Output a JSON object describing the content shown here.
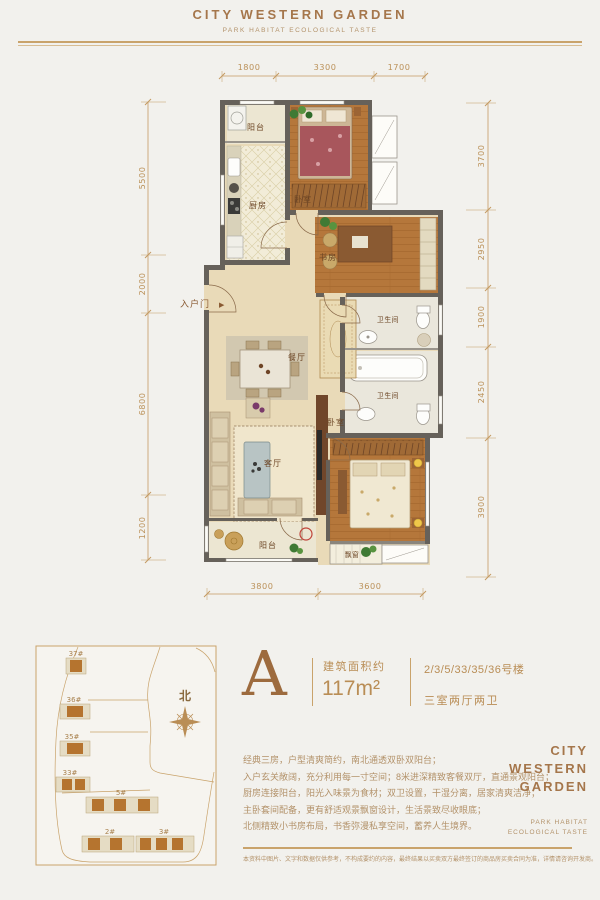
{
  "header": {
    "title": "CITY WESTERN GARDEN",
    "subtitle": "PARK HABITAT ECOLOGICAL TASTE"
  },
  "floor_plan": {
    "dims": {
      "top": [
        "1800",
        "3300",
        "1700"
      ],
      "bottom": [
        "3800",
        "3600"
      ],
      "left": [
        "5500",
        "2000",
        "6800",
        "1200"
      ],
      "right": [
        "3700",
        "2950",
        "1900",
        "2450",
        "3900"
      ]
    },
    "labels": {
      "balcony_top": "阳台",
      "kitchen": "厨房",
      "bedroom_north": "卧室",
      "study": "书房",
      "bath_upper": "卫生间",
      "bath_lower": "卫生间",
      "dining": "餐厅",
      "living": "客厅",
      "bedroom_master": "卧室",
      "balcony_bottom": "阳台",
      "bay_window": "飘窗",
      "entrance": "入户门",
      "entrance_arrow": "▶"
    }
  },
  "site_map": {
    "north": "北",
    "buildings": [
      "37#",
      "36#",
      "35#",
      "33#",
      "5#",
      "2#",
      "3#"
    ]
  },
  "unit": {
    "type_letter": "A",
    "area_label": "建筑面积约",
    "area_value": "117m²",
    "buildings_line": "2/3/5/33/35/36号楼",
    "layout_line": "三室两厅两卫"
  },
  "description": {
    "lines": [
      "经典三房，户型清爽简约，南北通透双卧双阳台；",
      "入户玄关敞阔，充分利用每一寸空间；8米进深精致客餐双厅，直通景观阳台；",
      "厨房连接阳台，阳光入味景为食材；双卫设置，干湿分离，居家清爽洁净；",
      "主卧套间配备，更有舒适观景飘窗设计，生活景致尽收眼底；",
      "北侧精致小书房布局，书香弥漫私享空间，蓄养人生境界。"
    ]
  },
  "brand": {
    "line1": "CITY",
    "line2": "WESTERN",
    "line3": "GARDEN",
    "tag1": "PARK HABITAT",
    "tag2": "ECOLOGICAL TASTE"
  },
  "disclaimer": "本资料中图片、文字和数据仅供参考，不构成要约的内容，最终结果以买卖双方最终签订的商品房买卖合同为准，详情请咨询开发商。",
  "colors": {
    "accent_gold": "#c49a62",
    "brand_brown": "#a5764b",
    "wall_gray": "#66615a",
    "wood": "#b5773b",
    "beige": "#e9dab8",
    "tile": "#f2ecd8"
  }
}
